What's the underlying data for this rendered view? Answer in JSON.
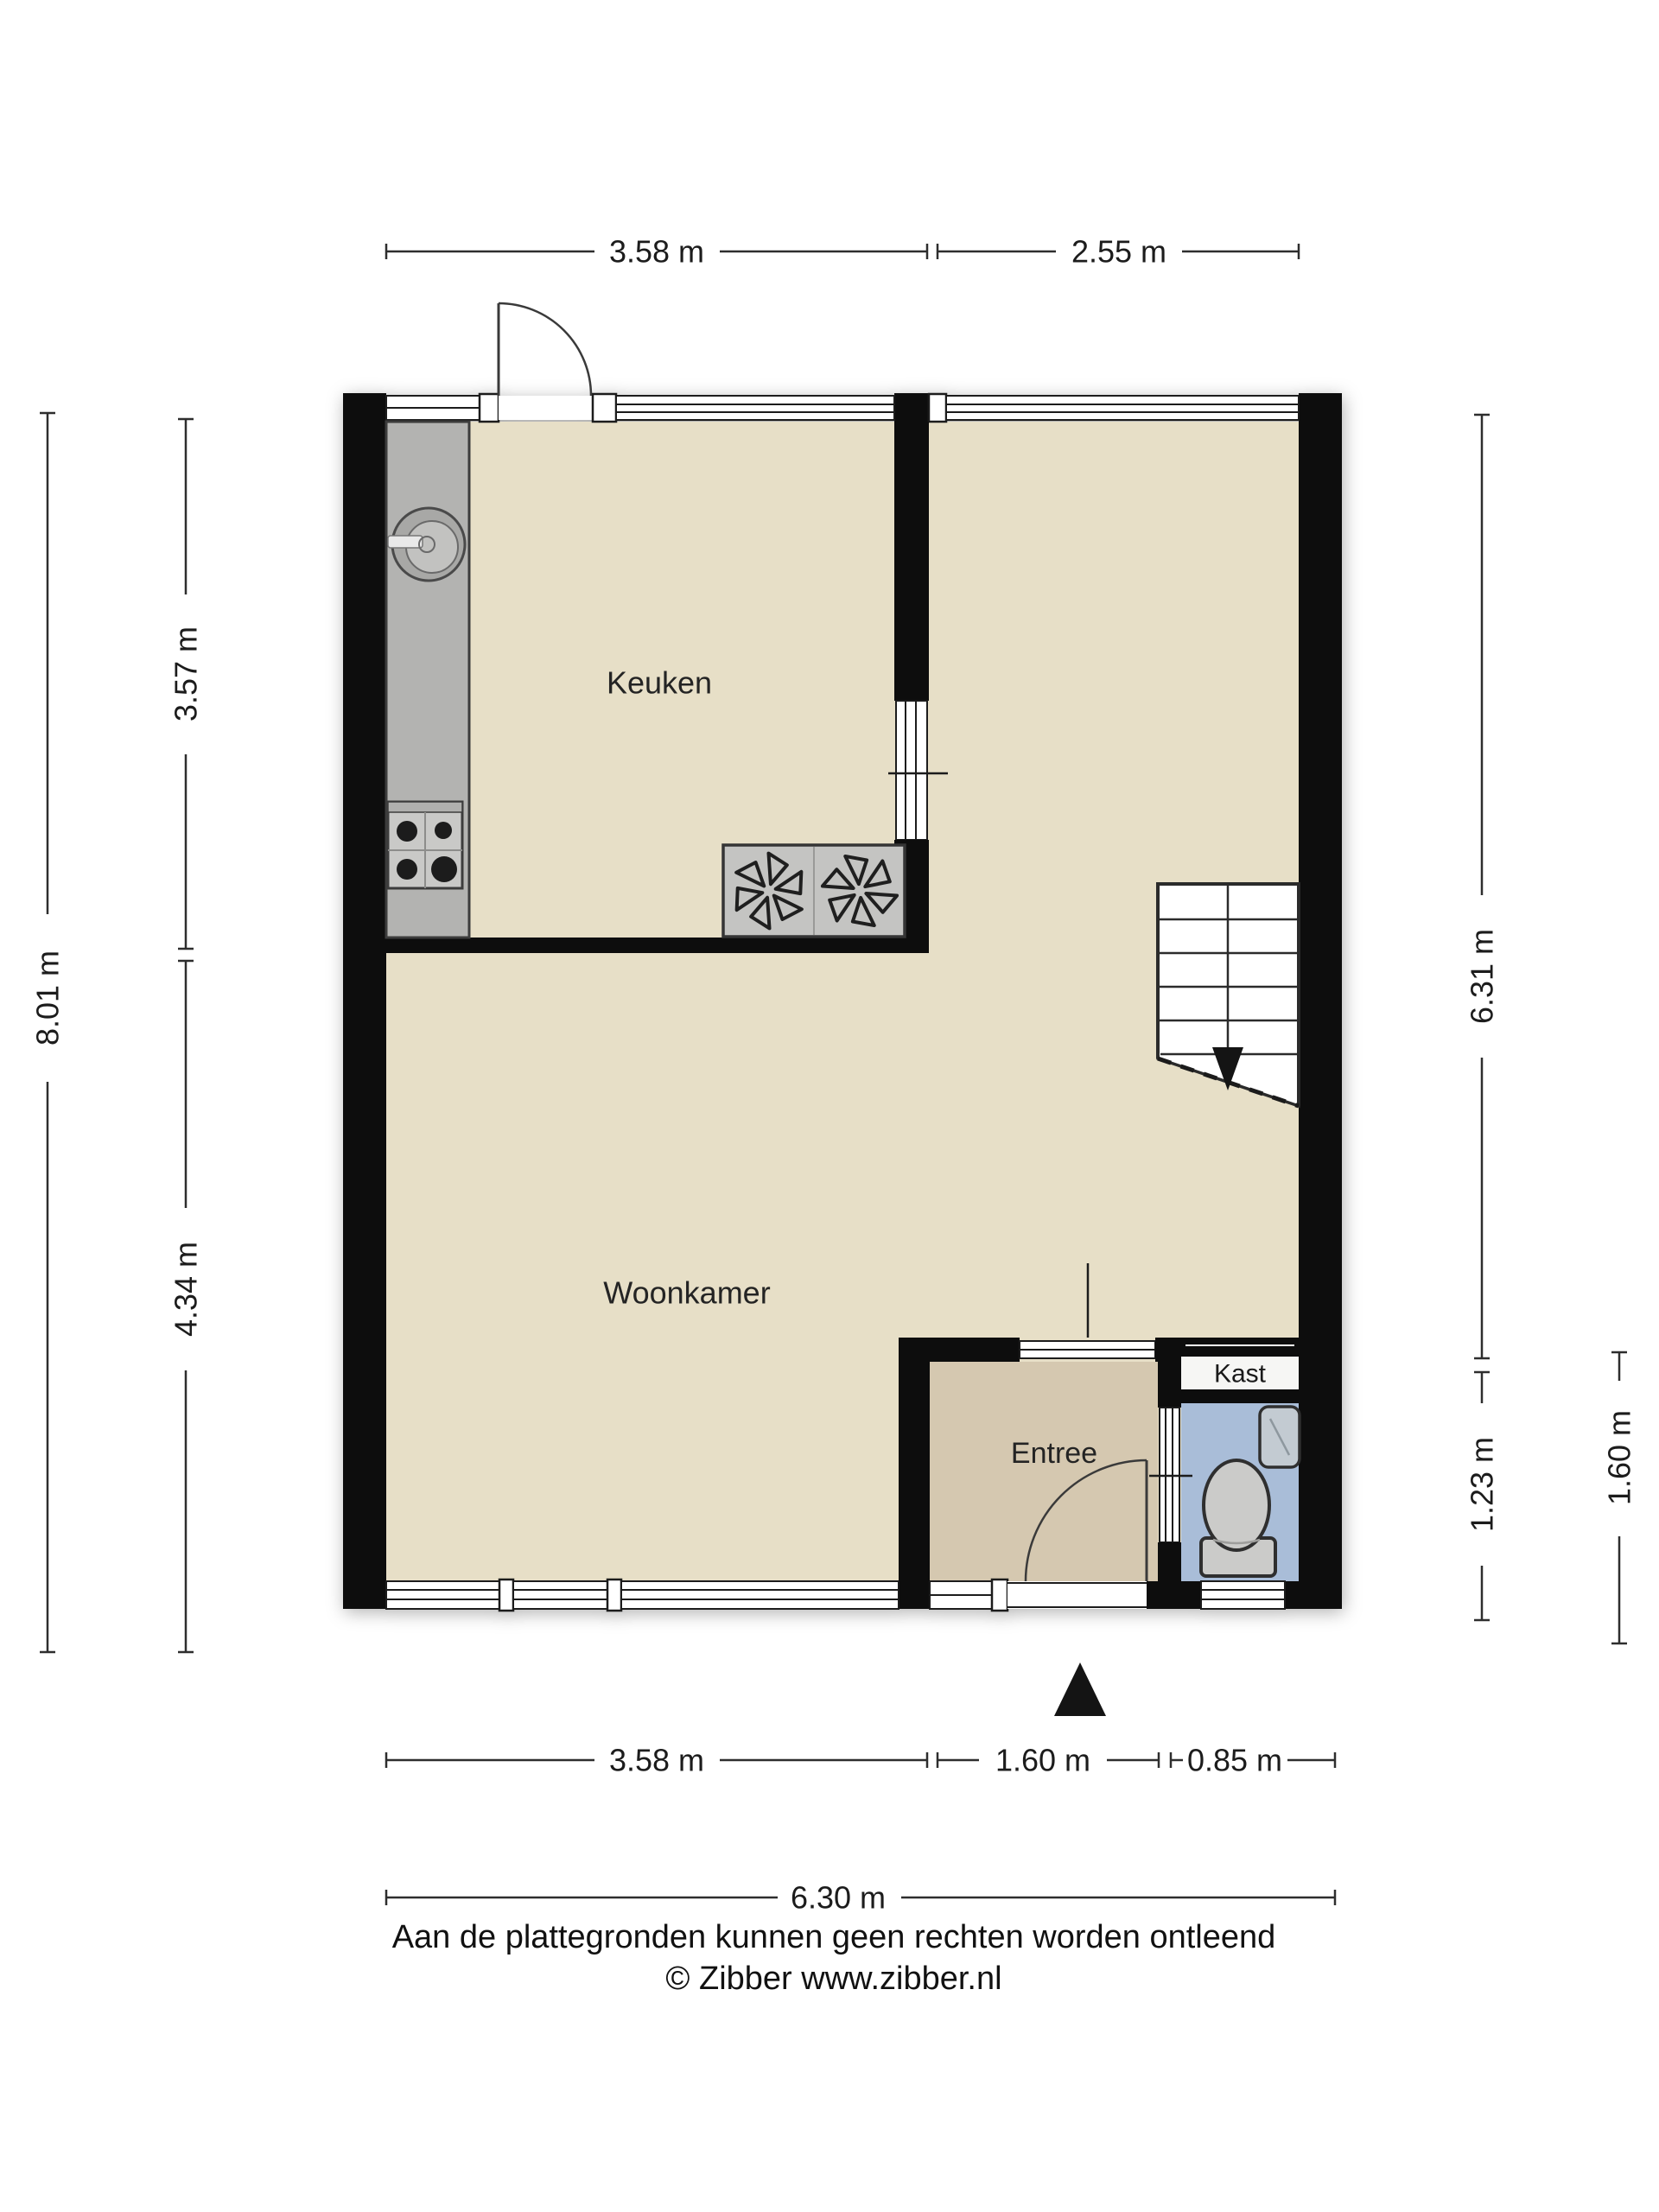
{
  "plan": {
    "rooms": {
      "keuken": {
        "label": "Keuken"
      },
      "woonkamer": {
        "label": "Woonkamer"
      },
      "entree": {
        "label": "Entree"
      },
      "kast": {
        "label": "Kast"
      }
    },
    "fixtures": [
      "sink",
      "stove",
      "extractor-fans",
      "stairs-down",
      "toilet",
      "hand-basin",
      "north-arrow"
    ]
  },
  "dimensions": {
    "top_left": "3.58 m",
    "top_right": "2.55 m",
    "left_outer": "8.01 m",
    "left_inner_top": "3.57 m",
    "left_inner_bottom": "4.34 m",
    "right_inner_top": "6.31 m",
    "right_inner_bottom": "1.23 m",
    "right_outer": "1.60 m",
    "bottom_left": "3.58 m",
    "bottom_middle": "1.60 m",
    "bottom_right": "0.85 m",
    "bottom_total": "6.30 m"
  },
  "footer": {
    "disclaimer": "Aan de plattegronden kunnen geen rechten worden ontleend",
    "copyright": "© Zibber www.zibber.nl"
  },
  "colors": {
    "wall": "#101010",
    "floor": "#e7dfc7",
    "entree-floor": "#d5c8b0",
    "toilet-floor": "#a9bdd8",
    "kast-floor": "#f6f6f4",
    "counter": "#b3b3b1",
    "fixture": "#cbcbc9",
    "line": "#2e2e2e",
    "text": "#1c1c1c",
    "bg": "#ffffff"
  }
}
